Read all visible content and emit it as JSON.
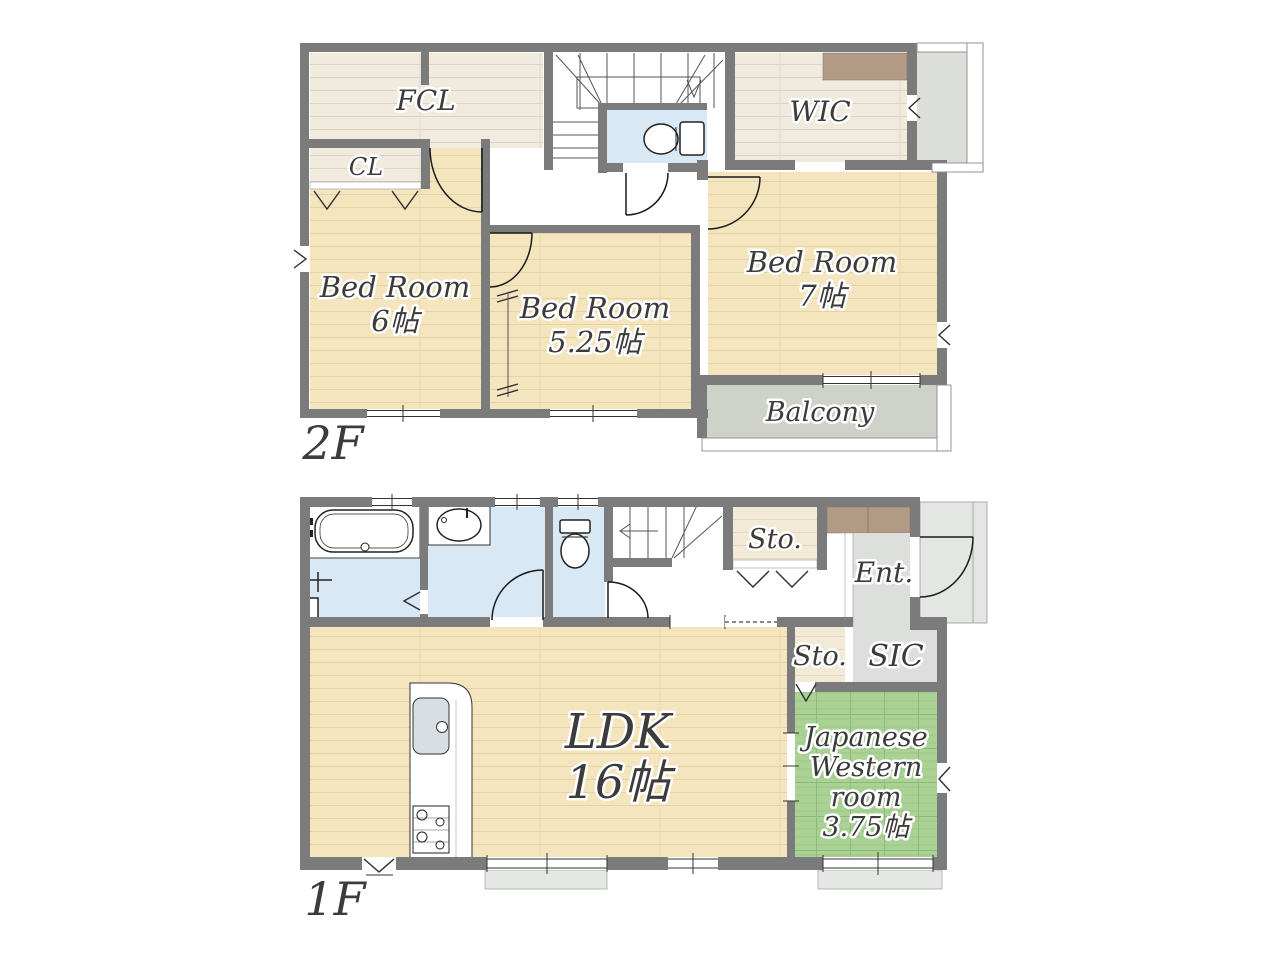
{
  "floors": {
    "f2": {
      "label": "2F",
      "rooms": {
        "fcl": "FCL",
        "cl": "CL",
        "bed6_l1": "Bed Room",
        "bed6_l2": "6帖",
        "bed525_l1": "Bed Room",
        "bed525_l2": "5.25帖",
        "bed7_l1": "Bed Room",
        "bed7_l2": "7帖",
        "wic": "WIC",
        "balcony": "Balcony"
      }
    },
    "f1": {
      "label": "1F",
      "rooms": {
        "sto_hall": "Sto.",
        "ent": "Ent.",
        "sto_tatami": "Sto.",
        "sic": "SIC",
        "ldk_l1": "LDK",
        "ldk_l2": "16帖",
        "jwr_l1": "Japanese",
        "jwr_l2": "Western",
        "jwr_l3": "room",
        "jwr_l4": "3.75帖"
      }
    }
  },
  "colors": {
    "wall": "#7b7b7b",
    "wood_floor": "#f4e5bf",
    "light_wood_floor": "#f0eadf",
    "wet_area": "#d9e8f5",
    "tatami": "#aad295",
    "balcony": "#cfd2c9",
    "entrance": "#dcdfdb",
    "closet": "#b39a84",
    "label_text": "#3c3c3c"
  }
}
